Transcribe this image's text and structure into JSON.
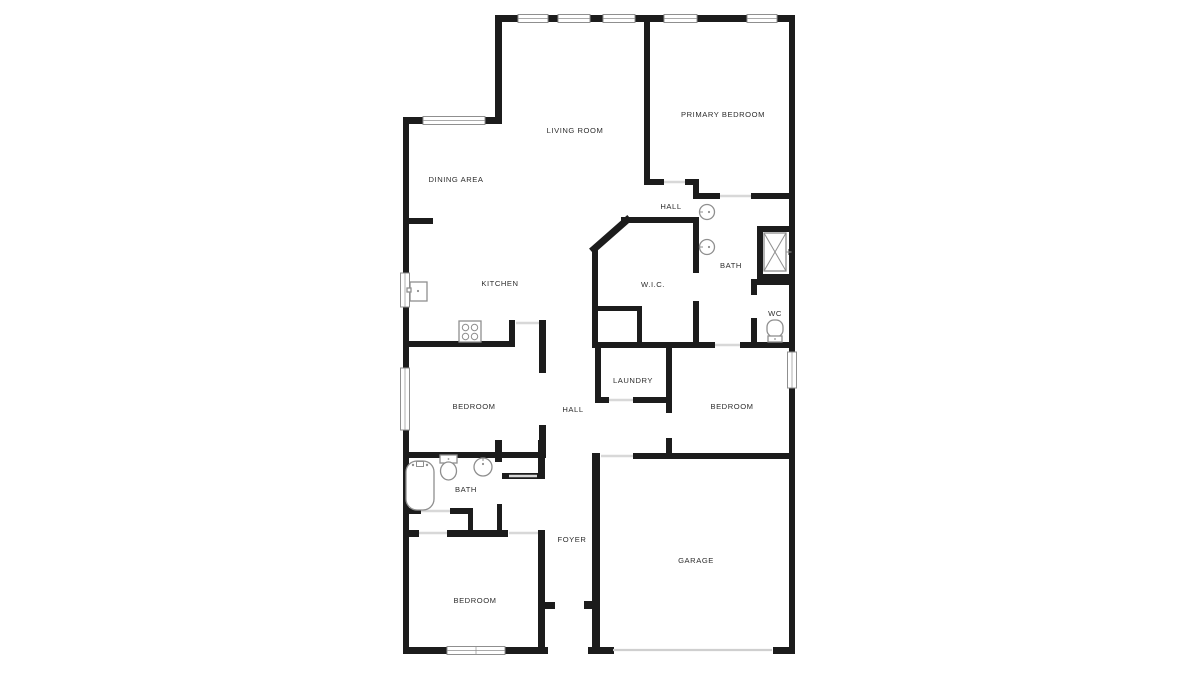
{
  "document": {
    "type": "floor-plan"
  },
  "colors": {
    "background": "#ffffff",
    "wall": "#1c1c1c",
    "fixture_outline": "#8f8f8f",
    "door_opening_line": "#d8d8d8",
    "label_text": "#2d2d2d"
  },
  "rooms": [
    {
      "id": "living-room",
      "label": "LIVING ROOM"
    },
    {
      "id": "primary-bedroom",
      "label": "PRIMARY BEDROOM"
    },
    {
      "id": "dining-area",
      "label": "DINING AREA"
    },
    {
      "id": "hall-upper",
      "label": "HALL"
    },
    {
      "id": "kitchen",
      "label": "KITCHEN"
    },
    {
      "id": "wic",
      "label": "W.I.C."
    },
    {
      "id": "bath-primary",
      "label": "BATH"
    },
    {
      "id": "wc",
      "label": "WC"
    },
    {
      "id": "laundry",
      "label": "LAUNDRY"
    },
    {
      "id": "bedroom-right",
      "label": "BEDROOM"
    },
    {
      "id": "bedroom-middle",
      "label": "BEDROOM"
    },
    {
      "id": "hall-lower",
      "label": "HALL"
    },
    {
      "id": "bath-hall",
      "label": "BATH"
    },
    {
      "id": "foyer",
      "label": "FOYER"
    },
    {
      "id": "bedroom-bottom",
      "label": "BEDROOM"
    },
    {
      "id": "garage",
      "label": "GARAGE"
    }
  ],
  "fixture_icons": [
    "shower-icon",
    "sink-icon",
    "sink-icon",
    "toilet-icon",
    "bathtub-icon",
    "toilet-icon",
    "sink-icon",
    "stove-icon",
    "refrigerator-icon"
  ]
}
